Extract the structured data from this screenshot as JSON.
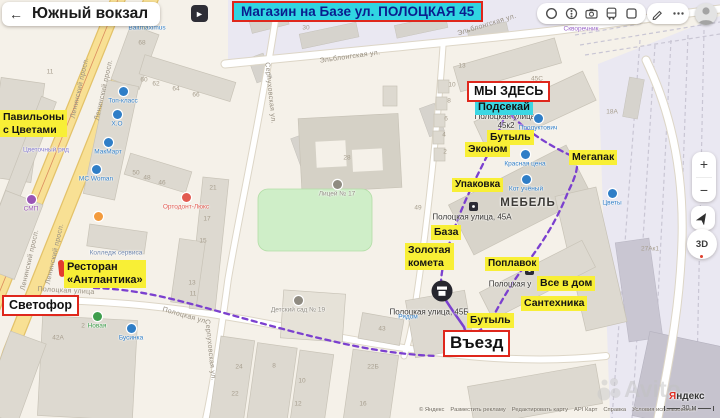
{
  "header": {
    "title": "Южный вокзал",
    "back_icon": "←"
  },
  "photo_badge": {
    "glyph": "►"
  },
  "banner": {
    "text": "Магазин на Базе ул. ПОЛОЦКАЯ 45"
  },
  "controls": {
    "zoom_in": "+",
    "zoom_out": "−",
    "dial": "3D"
  },
  "colors": {
    "highlight_yellow": "#f8ef36",
    "highlight_cyan": "#3bd7e3",
    "accent_red": "#df271c",
    "route_purple": "#7b40cf",
    "poi_blue": "#2f7ec7",
    "poi_gray": "#8f8b81",
    "poi_red": "#e25a50",
    "poi_green": "#3f9e4d",
    "poi_purple": "#9a55b5"
  },
  "map": {
    "territory_label": {
      "text": "МЕБЕЛЬ",
      "x": 528,
      "y": 203
    },
    "street_labels": [
      {
        "text": "Ленинский просп.",
        "x": 80,
        "y": 88,
        "rot": -77
      },
      {
        "text": "Ленинский просп.",
        "x": 104,
        "y": 90,
        "rot": -77
      },
      {
        "text": "Ленинский просп.",
        "x": 30,
        "y": 260,
        "rot": -77
      },
      {
        "text": "Ленинский просп.",
        "x": 55,
        "y": 254,
        "rot": -77
      },
      {
        "text": "Эльблонгская ул.",
        "x": 350,
        "y": 57,
        "rot": -8
      },
      {
        "text": "Эльблонгская ул.",
        "x": 487,
        "y": 25,
        "rot": -17
      },
      {
        "text": "Серпуховская ул.",
        "x": 270,
        "y": 93,
        "rot": 84
      },
      {
        "text": "Серпуховская ул.",
        "x": 210,
        "y": 350,
        "rot": 84
      },
      {
        "text": "Полоцкая улица",
        "x": 66,
        "y": 291,
        "rot": 3
      },
      {
        "text": "Полоцкая ул.",
        "x": 185,
        "y": 316,
        "rot": 16
      }
    ],
    "building_numbers": [
      {
        "t": "11",
        "x": 50,
        "y": 72
      },
      {
        "t": "68",
        "x": 142,
        "y": 43
      },
      {
        "t": "60",
        "x": 144,
        "y": 80
      },
      {
        "t": "62",
        "x": 156,
        "y": 84
      },
      {
        "t": "64",
        "x": 176,
        "y": 89
      },
      {
        "t": "66",
        "x": 196,
        "y": 95
      },
      {
        "t": "30",
        "x": 306,
        "y": 28
      },
      {
        "t": "13",
        "x": 462,
        "y": 66
      },
      {
        "t": "50",
        "x": 136,
        "y": 173
      },
      {
        "t": "48",
        "x": 147,
        "y": 178
      },
      {
        "t": "46",
        "x": 162,
        "y": 183
      },
      {
        "t": "21",
        "x": 213,
        "y": 188
      },
      {
        "t": "17",
        "x": 207,
        "y": 219
      },
      {
        "t": "15",
        "x": 203,
        "y": 241
      },
      {
        "t": "28",
        "x": 347,
        "y": 158
      },
      {
        "t": "49",
        "x": 418,
        "y": 208
      },
      {
        "t": "45С",
        "x": 537,
        "y": 79
      },
      {
        "t": "18А",
        "x": 612,
        "y": 112
      },
      {
        "t": "10",
        "x": 452,
        "y": 85
      },
      {
        "t": "8",
        "x": 449,
        "y": 101
      },
      {
        "t": "6",
        "x": 446,
        "y": 119
      },
      {
        "t": "4",
        "x": 444,
        "y": 135
      },
      {
        "t": "2",
        "x": 445,
        "y": 152
      },
      {
        "t": "27Ак1",
        "x": 650,
        "y": 249
      },
      {
        "t": "42А",
        "x": 58,
        "y": 338
      },
      {
        "t": "2",
        "x": 83,
        "y": 326
      },
      {
        "t": "13",
        "x": 192,
        "y": 283
      },
      {
        "t": "11",
        "x": 193,
        "y": 294
      },
      {
        "t": "24",
        "x": 239,
        "y": 367
      },
      {
        "t": "22",
        "x": 235,
        "y": 394
      },
      {
        "t": "8",
        "x": 274,
        "y": 366
      },
      {
        "t": "10",
        "x": 302,
        "y": 381
      },
      {
        "t": "12",
        "x": 298,
        "y": 404
      },
      {
        "t": "16",
        "x": 363,
        "y": 404
      },
      {
        "t": "22Б",
        "x": 373,
        "y": 367
      },
      {
        "t": "43",
        "x": 382,
        "y": 329
      }
    ],
    "pois": [
      {
        "label": "Топ-класс",
        "x": 123,
        "y": 91,
        "color": "#2f7ec7"
      },
      {
        "label": "Х.О",
        "x": 117,
        "y": 114,
        "color": "#2f7ec7"
      },
      {
        "label": "МакМарт",
        "x": 108,
        "y": 142,
        "color": "#2f7ec7"
      },
      {
        "label": "МС Woman",
        "x": 96,
        "y": 169,
        "color": "#2f7ec7"
      },
      {
        "label": "Цветочный ряд",
        "x": 46,
        "y": 150,
        "color": "#8379cf",
        "noicon": true
      },
      {
        "label": "СМП",
        "x": 31,
        "y": 199,
        "color": "#9a55b5"
      },
      {
        "label": "",
        "x": 98,
        "y": 216,
        "color": "#f39b3d"
      },
      {
        "label": "Колледж сервиса",
        "x": 116,
        "y": 253,
        "color": "#6f86ad",
        "noicon": true
      },
      {
        "label": "Новая",
        "x": 97,
        "y": 316,
        "color": "#3f9e4d"
      },
      {
        "label": "Бусинка",
        "x": 131,
        "y": 328,
        "color": "#2f7ec7"
      },
      {
        "label": "Baltmaximus",
        "x": 147,
        "y": 28,
        "color": "#2f7ec7",
        "noicon": true
      },
      {
        "label": "Продуктович",
        "x": 538,
        "y": 118,
        "color": "#2f7ec7"
      },
      {
        "label": "Красная цена",
        "x": 525,
        "y": 154,
        "color": "#2f7ec7"
      },
      {
        "label": "Кот учёный",
        "x": 526,
        "y": 179,
        "color": "#2f7ec7"
      },
      {
        "label": "Цветы",
        "x": 612,
        "y": 193,
        "color": "#2f7ec7"
      },
      {
        "label": "Рядом",
        "x": 408,
        "y": 317,
        "color": "#2f7ec7",
        "noicon": true
      },
      {
        "label": "Скворечник",
        "x": 581,
        "y": 29,
        "color": "#9a66c8",
        "noicon": true
      },
      {
        "label": "Лицей № 17",
        "x": 337,
        "y": 184,
        "color": "#8f8b81"
      },
      {
        "label": "Детский\nсад № 19",
        "x": 298,
        "y": 300,
        "color": "#8f8b81"
      },
      {
        "label": "Ортодонт-Люкс",
        "x": 186,
        "y": 197,
        "color": "#e25a50"
      }
    ],
    "addresses": [
      {
        "text": "Полоцкая улица,\n45к2",
        "x": 506,
        "y": 121
      },
      {
        "text": "Полоцкая улица, 45А",
        "x": 472,
        "y": 217
      },
      {
        "text": "Полоцкая улица, 45Б",
        "x": 429,
        "y": 312
      },
      {
        "text": "Полоцкая у",
        "x": 510,
        "y": 284
      }
    ],
    "yellow_tags": [
      {
        "text": "Павильоны\nс Цветами",
        "x": 0,
        "y": 110,
        "fs": 10.5
      },
      {
        "text": "Бутыль",
        "x": 487,
        "y": 130,
        "fs": 10.5
      },
      {
        "text": "Эконом",
        "x": 465,
        "y": 142,
        "fs": 10.5
      },
      {
        "text": "Мегапак",
        "x": 569,
        "y": 150,
        "fs": 10.5
      },
      {
        "text": "Упаковка",
        "x": 452,
        "y": 178,
        "fs": 10
      },
      {
        "text": "База",
        "x": 431,
        "y": 225,
        "fs": 10.5
      },
      {
        "text": "Золотая\nкомета",
        "x": 405,
        "y": 243,
        "fs": 10.5
      },
      {
        "text": "Поплавок",
        "x": 485,
        "y": 257,
        "fs": 10
      },
      {
        "text": "Все в дом",
        "x": 537,
        "y": 276,
        "fs": 10.5
      },
      {
        "text": "Сантехника",
        "x": 521,
        "y": 296,
        "fs": 10.5
      },
      {
        "text": "Бутыль",
        "x": 467,
        "y": 313,
        "fs": 10.5
      },
      {
        "text": "Ресторан\n«Антлантика»",
        "x": 64,
        "y": 260,
        "fs": 11
      }
    ],
    "cyan_tags": [
      {
        "text": "Подсекай",
        "x": 475,
        "y": 100,
        "fs": 11
      }
    ],
    "red_boxes": [
      {
        "text": "МЫ ЗДЕСЬ",
        "x": 467,
        "y": 81,
        "fs": 12.5
      },
      {
        "text": "Светофор",
        "x": 2,
        "y": 295,
        "fs": 12.5
      },
      {
        "text": "Въезд",
        "x": 443,
        "y": 330,
        "fs": 17
      }
    ]
  },
  "attribution": {
    "links": [
      "© Яндекс",
      "Разместить рекламу",
      "Редактировать карту",
      "API Карт",
      "Справка",
      "Условия использования"
    ],
    "logo_first": "Я",
    "logo_rest": "ндекс",
    "scale": "30 м",
    "watermark": "Avito"
  }
}
